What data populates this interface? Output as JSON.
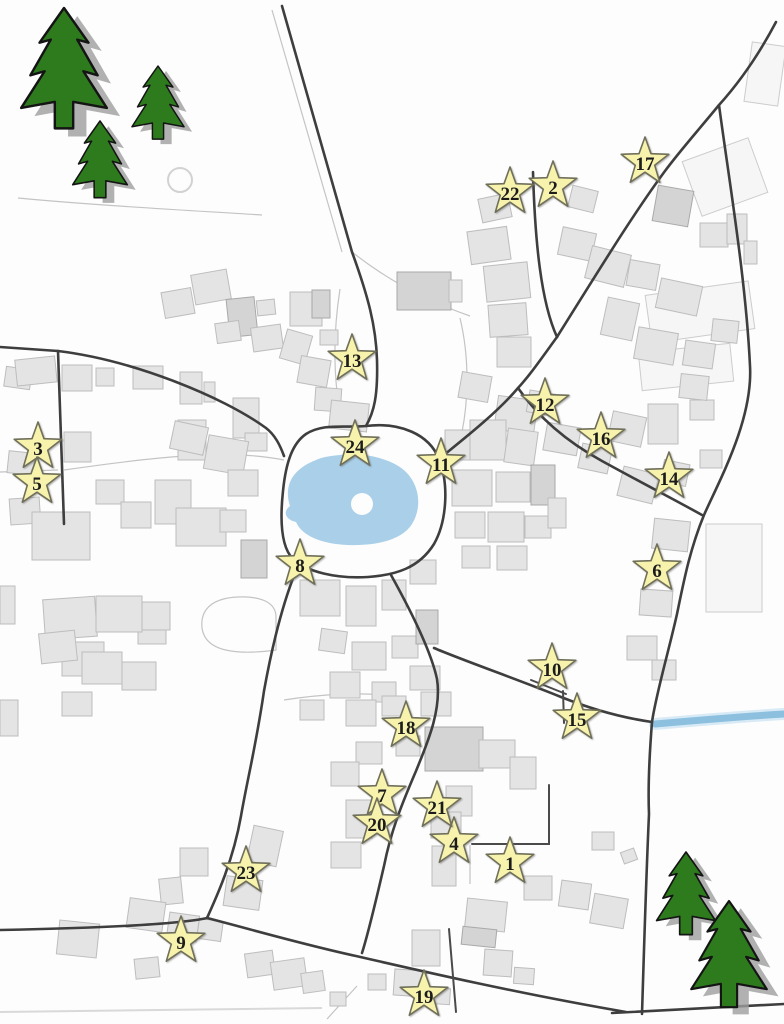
{
  "map": {
    "title": "village-advent-map",
    "colors": {
      "background": "#fdfdfd",
      "road": "#3e3e3e",
      "building_fill": "#e4e4e4",
      "building_dark": "#d4d4d4",
      "pond_blue": "#a9cfe9",
      "stream_blue": "#8cc0de",
      "star_fill": "#f7f3ad",
      "star_stroke": "#70705a",
      "tree_green": "#2e7b1e"
    },
    "stars": [
      {
        "n": "1",
        "x": 510,
        "y": 862
      },
      {
        "n": "2",
        "x": 553,
        "y": 186
      },
      {
        "n": "3",
        "x": 38,
        "y": 447
      },
      {
        "n": "4",
        "x": 454,
        "y": 842
      },
      {
        "n": "5",
        "x": 37,
        "y": 482
      },
      {
        "n": "6",
        "x": 657,
        "y": 569
      },
      {
        "n": "7",
        "x": 382,
        "y": 794
      },
      {
        "n": "8",
        "x": 300,
        "y": 564
      },
      {
        "n": "9",
        "x": 181,
        "y": 941
      },
      {
        "n": "10",
        "x": 552,
        "y": 668
      },
      {
        "n": "11",
        "x": 441,
        "y": 463
      },
      {
        "n": "12",
        "x": 545,
        "y": 403
      },
      {
        "n": "13",
        "x": 352,
        "y": 359
      },
      {
        "n": "14",
        "x": 669,
        "y": 477
      },
      {
        "n": "15",
        "x": 577,
        "y": 718
      },
      {
        "n": "16",
        "x": 601,
        "y": 437
      },
      {
        "n": "17",
        "x": 645,
        "y": 162
      },
      {
        "n": "18",
        "x": 406,
        "y": 726
      },
      {
        "n": "19",
        "x": 424,
        "y": 995
      },
      {
        "n": "20",
        "x": 377,
        "y": 823
      },
      {
        "n": "21",
        "x": 437,
        "y": 806
      },
      {
        "n": "22",
        "x": 510,
        "y": 192
      },
      {
        "n": "23",
        "x": 246,
        "y": 871
      },
      {
        "n": "24",
        "x": 355,
        "y": 445
      }
    ],
    "trees": [
      {
        "x": 64,
        "y": 8,
        "s": 1.02
      },
      {
        "x": 158,
        "y": 66,
        "s": 0.62
      },
      {
        "x": 100,
        "y": 121,
        "s": 0.65
      },
      {
        "x": 686,
        "y": 852,
        "s": 0.7
      },
      {
        "x": 729,
        "y": 901,
        "s": 0.9
      }
    ],
    "pond": {
      "path": "M316,460 C290,470 284,488 290,506 C282,512 286,520 296,522 C302,536 322,544 348,545 C376,546 402,540 412,524 C422,508 420,486 406,472 C392,458 362,452 340,455 C330,456 322,457 316,460 Z",
      "island": {
        "cx": 362,
        "cy": 504,
        "r": 11
      }
    },
    "stream": {
      "path": "M655,724 C700,720 750,716 784,714"
    },
    "roads_major": [
      "M282,6 L352,252 C368,296 376,326 377,360 C378,396 374,412 366,426",
      "M366,426 C400,422 429,434 439,459 C449,484 447,521 434,544 C419,568 396,575 368,577 C337,579 307,572 293,559 C281,547 280,519 283,491 C286,461 293,443 306,434 C323,423 344,428 366,426 Z",
      "M533,172 C535,242 541,302 557,337",
      "M776,22 C756,60 737,85 719,105 C696,133 679,152 665,171 C634,213 604,262 557,337",
      "M557,337 C541,359 530,375 518,388 C496,414 461,441 439,459",
      "M518,388 C536,414 562,439 602,461 C642,483 677,501 702,515",
      "M719,105 C729,180 746,280 750,366 C753,420 719,481 704,515 C690,549 684,580 677,614 C669,650 656,694 652,722 C649,760 648,790 649,814 C646,880 644,950 642,1014",
      "M434,648 C462,660 522,681 561,697 C601,713 631,719 652,722",
      "M391,575 C411,611 431,651 437,679 C442,711 426,746 416,771 C401,806 391,831 384,866 C377,896 369,931 362,953",
      "M295,573 C284,601 273,641 264,691 C256,746 247,781 241,816 C233,861 217,896 207,918",
      "M207,918 C180,924 100,928 0,930",
      "M207,918 C250,929 301,944 356,956 C421,971 521,994 626,1012",
      "M0,347 L58,351",
      "M58,351 C132,360 222,396 266,428 C275,435 280,445 284,456",
      "M58,351 C60,402 62,462 64,524",
      "M612,1013 L784,1004"
    ],
    "roads_thin": [
      "M563,691 L564,723",
      "M549,785 L549,844 L472,844",
      "M449,929 L456,1012",
      "M531,680 L566,694"
    ],
    "roads_minor": [
      "M272,10 L342,252",
      "M64,470 C150,458 225,448 284,460",
      "M0,472 L58,470",
      "M18,198 C100,206 200,211 262,215",
      "M352,252 C395,286 438,305 470,316",
      "M340,289 C332,340 334,386 342,423",
      "M460,318 C470,360 468,402 462,432",
      "M276,650 C232,656 205,650 202,628 C200,608 214,598 238,597 C262,596 276,603 276,617 Z",
      "M284,700 C322,694 362,692 392,696",
      "M470,845 L470,884",
      "M327,1019 L357,986"
    ],
    "edge_lines": [
      "M0,1012 L322,1008"
    ],
    "circle_outline": {
      "cx": 180,
      "cy": 180,
      "r": 12
    },
    "fields": [
      [
        706,
        524,
        56,
        88,
        0
      ],
      [
        690,
        148,
        70,
        58,
        -20
      ],
      [
        648,
        288,
        104,
        48,
        -8
      ],
      [
        640,
        348,
        92,
        38,
        -6
      ],
      [
        748,
        44,
        34,
        60,
        8
      ]
    ],
    "buildings": [
      [
        5,
        368,
        26,
        20,
        8,
        0
      ],
      [
        16,
        358,
        40,
        26,
        -6,
        0
      ],
      [
        62,
        365,
        30,
        26,
        0,
        0
      ],
      [
        96,
        368,
        18,
        18,
        0,
        0
      ],
      [
        133,
        366,
        30,
        23,
        0,
        0
      ],
      [
        180,
        372,
        22,
        32,
        0,
        0
      ],
      [
        204,
        382,
        11,
        20,
        0,
        0
      ],
      [
        178,
        420,
        28,
        40,
        0,
        0
      ],
      [
        64,
        432,
        27,
        30,
        0,
        0
      ],
      [
        8,
        452,
        26,
        22,
        6,
        0
      ],
      [
        10,
        498,
        30,
        26,
        -4,
        0
      ],
      [
        32,
        512,
        58,
        48,
        0,
        0
      ],
      [
        44,
        598,
        52,
        40,
        -4,
        0
      ],
      [
        62,
        642,
        42,
        34,
        0,
        0
      ],
      [
        138,
        618,
        28,
        26,
        0,
        0
      ],
      [
        0,
        586,
        15,
        38,
        0,
        0
      ],
      [
        163,
        290,
        30,
        26,
        -10,
        0
      ],
      [
        193,
        272,
        36,
        30,
        -10,
        0
      ],
      [
        228,
        298,
        28,
        38,
        -6,
        1
      ],
      [
        257,
        300,
        18,
        15,
        -6,
        0
      ],
      [
        216,
        322,
        24,
        20,
        -8,
        0
      ],
      [
        252,
        326,
        30,
        24,
        -8,
        0
      ],
      [
        290,
        292,
        32,
        34,
        0,
        0
      ],
      [
        312,
        290,
        18,
        28,
        0,
        1
      ],
      [
        397,
        272,
        54,
        38,
        0,
        1
      ],
      [
        449,
        280,
        13,
        22,
        0,
        0
      ],
      [
        283,
        332,
        26,
        30,
        16,
        0
      ],
      [
        299,
        358,
        30,
        27,
        10,
        0
      ],
      [
        315,
        388,
        26,
        23,
        4,
        0
      ],
      [
        330,
        402,
        38,
        28,
        6,
        0
      ],
      [
        320,
        330,
        18,
        15,
        0,
        0
      ],
      [
        233,
        398,
        26,
        40,
        0,
        0
      ],
      [
        245,
        433,
        22,
        18,
        0,
        0
      ],
      [
        480,
        196,
        30,
        24,
        -12,
        0
      ],
      [
        469,
        229,
        40,
        33,
        -8,
        0
      ],
      [
        485,
        264,
        44,
        36,
        -6,
        0
      ],
      [
        489,
        304,
        38,
        32,
        -4,
        0
      ],
      [
        497,
        337,
        34,
        30,
        0,
        0
      ],
      [
        460,
        374,
        30,
        26,
        10,
        0
      ],
      [
        496,
        398,
        40,
        34,
        8,
        0
      ],
      [
        570,
        188,
        26,
        22,
        14,
        0
      ],
      [
        655,
        188,
        36,
        36,
        10,
        1
      ],
      [
        560,
        230,
        34,
        28,
        12,
        0
      ],
      [
        588,
        250,
        40,
        33,
        14,
        0
      ],
      [
        628,
        262,
        30,
        26,
        10,
        0
      ],
      [
        658,
        282,
        42,
        30,
        12,
        0
      ],
      [
        604,
        300,
        32,
        38,
        12,
        0
      ],
      [
        636,
        330,
        40,
        32,
        10,
        0
      ],
      [
        684,
        342,
        30,
        25,
        8,
        0
      ],
      [
        700,
        223,
        28,
        24,
        0,
        0
      ],
      [
        727,
        214,
        20,
        30,
        0,
        0
      ],
      [
        744,
        241,
        13,
        23,
        0,
        0
      ],
      [
        712,
        320,
        26,
        22,
        6,
        0
      ],
      [
        528,
        392,
        26,
        22,
        10,
        0
      ],
      [
        545,
        425,
        34,
        28,
        10,
        0
      ],
      [
        580,
        446,
        30,
        25,
        12,
        0
      ],
      [
        610,
        414,
        34,
        30,
        12,
        0
      ],
      [
        648,
        404,
        30,
        40,
        0,
        0
      ],
      [
        690,
        400,
        24,
        20,
        0,
        0
      ],
      [
        620,
        470,
        36,
        30,
        14,
        0
      ],
      [
        662,
        462,
        26,
        22,
        12,
        0
      ],
      [
        700,
        450,
        22,
        18,
        0,
        0
      ],
      [
        653,
        520,
        36,
        30,
        6,
        0
      ],
      [
        640,
        590,
        32,
        26,
        4,
        0
      ],
      [
        627,
        636,
        30,
        24,
        0,
        0
      ],
      [
        652,
        660,
        24,
        20,
        0,
        0
      ],
      [
        680,
        375,
        28,
        24,
        6,
        0
      ],
      [
        445,
        430,
        26,
        30,
        0,
        0
      ],
      [
        470,
        420,
        36,
        40,
        0,
        0
      ],
      [
        506,
        430,
        30,
        34,
        8,
        0
      ],
      [
        452,
        470,
        40,
        36,
        0,
        0
      ],
      [
        496,
        472,
        34,
        30,
        0,
        0
      ],
      [
        531,
        465,
        24,
        40,
        0,
        1
      ],
      [
        455,
        512,
        30,
        26,
        0,
        0
      ],
      [
        488,
        512,
        36,
        30,
        0,
        0
      ],
      [
        525,
        516,
        26,
        22,
        0,
        0
      ],
      [
        548,
        498,
        18,
        30,
        0,
        0
      ],
      [
        462,
        546,
        28,
        22,
        0,
        0
      ],
      [
        497,
        546,
        30,
        24,
        0,
        0
      ],
      [
        300,
        580,
        40,
        36,
        0,
        0
      ],
      [
        346,
        586,
        30,
        40,
        0,
        0
      ],
      [
        382,
        580,
        24,
        30,
        0,
        0
      ],
      [
        410,
        560,
        26,
        24,
        0,
        0
      ],
      [
        320,
        630,
        26,
        22,
        8,
        0
      ],
      [
        352,
        642,
        34,
        28,
        0,
        0
      ],
      [
        392,
        636,
        26,
        22,
        0,
        0
      ],
      [
        416,
        610,
        22,
        34,
        0,
        1
      ],
      [
        330,
        672,
        30,
        26,
        0,
        0
      ],
      [
        372,
        682,
        24,
        20,
        0,
        0
      ],
      [
        410,
        666,
        30,
        24,
        0,
        0
      ],
      [
        300,
        700,
        24,
        20,
        0,
        0
      ],
      [
        172,
        424,
        34,
        28,
        12,
        0
      ],
      [
        206,
        438,
        40,
        34,
        10,
        0
      ],
      [
        228,
        470,
        30,
        26,
        0,
        0
      ],
      [
        155,
        480,
        36,
        44,
        0,
        0
      ],
      [
        176,
        508,
        50,
        38,
        0,
        0
      ],
      [
        220,
        510,
        26,
        22,
        0,
        0
      ],
      [
        96,
        480,
        28,
        24,
        0,
        0
      ],
      [
        121,
        502,
        30,
        26,
        0,
        0
      ],
      [
        241,
        540,
        26,
        38,
        0,
        1
      ],
      [
        96,
        596,
        46,
        36,
        0,
        0
      ],
      [
        142,
        602,
        28,
        28,
        0,
        0
      ],
      [
        40,
        632,
        36,
        30,
        -6,
        0
      ],
      [
        82,
        652,
        40,
        32,
        0,
        0
      ],
      [
        122,
        662,
        34,
        28,
        0,
        0
      ],
      [
        62,
        692,
        30,
        24,
        0,
        0
      ],
      [
        0,
        700,
        18,
        36,
        0,
        0
      ],
      [
        346,
        700,
        30,
        26,
        0,
        0
      ],
      [
        382,
        696,
        24,
        20,
        0,
        0
      ],
      [
        356,
        742,
        26,
        22,
        0,
        0
      ],
      [
        331,
        762,
        28,
        24,
        0,
        0
      ],
      [
        346,
        800,
        26,
        38,
        0,
        0
      ],
      [
        331,
        842,
        30,
        26,
        0,
        0
      ],
      [
        396,
        736,
        24,
        20,
        0,
        0
      ],
      [
        421,
        692,
        30,
        24,
        0,
        0
      ],
      [
        425,
        727,
        58,
        44,
        0,
        1
      ],
      [
        479,
        740,
        36,
        28,
        0,
        0
      ],
      [
        510,
        757,
        26,
        32,
        0,
        0
      ],
      [
        446,
        786,
        26,
        30,
        0,
        0
      ],
      [
        431,
        812,
        30,
        26,
        0,
        0
      ],
      [
        432,
        846,
        24,
        40,
        0,
        0
      ],
      [
        466,
        900,
        40,
        30,
        6,
        0
      ],
      [
        524,
        876,
        28,
        24,
        0,
        0
      ],
      [
        560,
        882,
        30,
        26,
        8,
        0
      ],
      [
        592,
        896,
        34,
        30,
        10,
        0
      ],
      [
        592,
        832,
        22,
        18,
        0,
        0
      ],
      [
        250,
        828,
        30,
        36,
        12,
        0
      ],
      [
        225,
        878,
        36,
        30,
        8,
        0
      ],
      [
        180,
        848,
        28,
        28,
        0,
        0
      ],
      [
        160,
        878,
        22,
        26,
        -6,
        0
      ],
      [
        128,
        900,
        36,
        30,
        8,
        0
      ],
      [
        168,
        914,
        30,
        26,
        8,
        0
      ],
      [
        198,
        920,
        24,
        20,
        8,
        0
      ],
      [
        58,
        922,
        40,
        34,
        6,
        0
      ],
      [
        412,
        930,
        28,
        36,
        0,
        0
      ],
      [
        462,
        928,
        34,
        18,
        6,
        1
      ],
      [
        484,
        950,
        28,
        26,
        4,
        0
      ],
      [
        514,
        968,
        20,
        16,
        4,
        0
      ],
      [
        368,
        974,
        18,
        16,
        0,
        0
      ],
      [
        394,
        970,
        32,
        26,
        4,
        0
      ],
      [
        428,
        988,
        22,
        16,
        4,
        0
      ],
      [
        330,
        992,
        16,
        14,
        0,
        0
      ],
      [
        246,
        952,
        28,
        24,
        -8,
        0
      ],
      [
        272,
        960,
        34,
        28,
        -8,
        0
      ],
      [
        302,
        972,
        22,
        20,
        -8,
        0
      ],
      [
        135,
        958,
        24,
        20,
        -6,
        0
      ],
      [
        622,
        850,
        14,
        12,
        -20,
        0
      ]
    ],
    "tree_path": "M0,0 L24,34 L13,31 L33,66 L19,62 L42,98 L9,92 L9,118 L-9,118 L-9,92 L-42,98 L-19,62 L-33,66 L-13,31 L-24,34 Z"
  }
}
